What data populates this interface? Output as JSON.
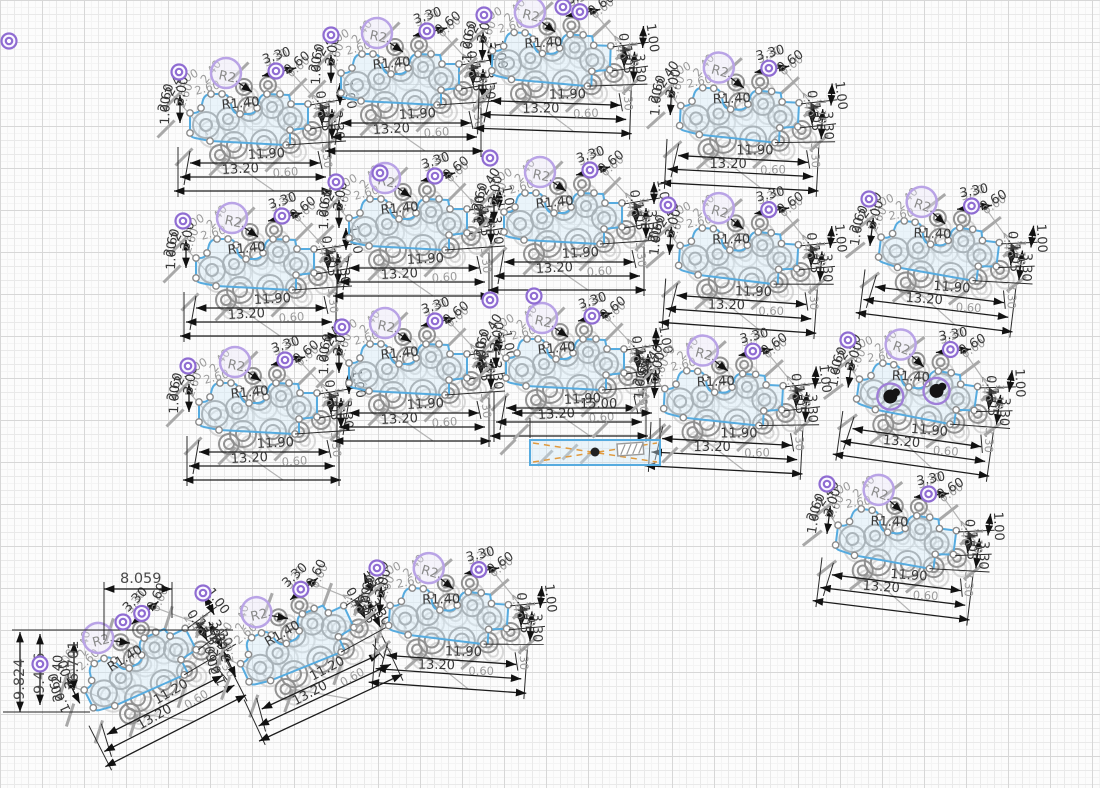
{
  "canvas": {
    "width": 1100,
    "height": 788,
    "background": "#fcfcfc",
    "grid": {
      "minor_px": 7,
      "medium_px": 14,
      "major_px": 42,
      "minor_color": "#f4f4f4",
      "medium_color": "#e9e9e9",
      "major_color": "#d7d7d7"
    }
  },
  "colors": {
    "profile_stroke": "#56abdf",
    "profile_fill": "rgba(208,232,247,0.40)",
    "geometry_gray": "#8e8e8e",
    "ghost_gray": "#b8b8b8",
    "construction_gray": "#a8a8a8",
    "dimension_black": "#1c1c1c",
    "dim_text": "#383838",
    "gray_text": "#9b9b9b",
    "constraint_purple": "#8f6cd2",
    "bubble_purple": "#b9a3e6",
    "bubble_fill": "rgba(232,225,250,0.35)",
    "selection_black": "#151515",
    "hatch_orange": "#e09a3e",
    "point_fill": "#ffffff"
  },
  "dimension_labels": {
    "overall_width": "13.20",
    "inner_width": "11.90",
    "alt_inner_width": "11.20",
    "fillet_radius": "R1.40",
    "bubble_radius": "R2",
    "height_330": "3.30",
    "height_105": "1.05",
    "height_110": "1.10",
    "height_100": "1.00",
    "width_260": "2.60",
    "width_240": "2.40",
    "width_300": "3.00",
    "width_045": "0.45",
    "width_060": "0.60"
  },
  "rotated_part_dims": {
    "top_width": "8.059",
    "height_left_outer": "9.824",
    "height_left_mid": "9.456",
    "height_left_inner": "6.701"
  },
  "strip": {
    "length_label": "15.00"
  },
  "clusters": [
    {
      "id": "A",
      "cx": 255,
      "cy": 126,
      "rot": 0
    },
    {
      "id": "B",
      "cx": 406,
      "cy": 86,
      "rot": 0
    },
    {
      "id": "C",
      "cx": 557,
      "cy": 66,
      "rot": 2
    },
    {
      "id": "D",
      "cx": 745,
      "cy": 122,
      "rot": 3
    },
    {
      "id": "E",
      "cx": 261,
      "cy": 271,
      "rot": 0
    },
    {
      "id": "F",
      "cx": 414,
      "cy": 231,
      "rot": 0
    },
    {
      "id": "G",
      "cx": 569,
      "cy": 225,
      "rot": 0
    },
    {
      "id": "H",
      "cx": 744,
      "cy": 263,
      "rot": 4
    },
    {
      "id": "I",
      "cx": 944,
      "cy": 258,
      "rot": 7
    },
    {
      "id": "J",
      "cx": 264,
      "cy": 415,
      "rot": 0
    },
    {
      "id": "K",
      "cx": 414,
      "cy": 376,
      "rot": 0
    },
    {
      "id": "L",
      "cx": 571,
      "cy": 371,
      "rot": 0
    },
    {
      "id": "M",
      "cx": 729,
      "cy": 405,
      "rot": 3
    },
    {
      "id": "N",
      "cx": 922,
      "cy": 401,
      "rot": 8,
      "selected_holes": true
    },
    {
      "id": "O",
      "cx": 901,
      "cy": 546,
      "rot": 7
    },
    {
      "id": "P",
      "cx": 148,
      "cy": 672,
      "rot": -27,
      "inner": "alt"
    },
    {
      "id": "Q",
      "cx": 305,
      "cy": 648,
      "rot": -25,
      "inner": "alt"
    },
    {
      "id": "R",
      "cx": 454,
      "cy": 623,
      "rot": 4
    }
  ],
  "constraint_icons": [
    [
      9,
      41
    ],
    [
      179,
      72
    ],
    [
      331,
      35
    ],
    [
      484,
      15
    ],
    [
      563,
      7
    ],
    [
      183,
      221
    ],
    [
      336,
      182
    ],
    [
      380,
      173
    ],
    [
      490,
      158
    ],
    [
      668,
      205
    ],
    [
      869,
      199
    ],
    [
      848,
      340
    ],
    [
      490,
      300
    ],
    [
      534,
      296
    ],
    [
      342,
      327
    ],
    [
      188,
      366
    ],
    [
      827,
      484
    ],
    [
      203,
      593
    ],
    [
      377,
      568
    ],
    [
      123,
      622
    ],
    [
      40,
      664
    ]
  ]
}
